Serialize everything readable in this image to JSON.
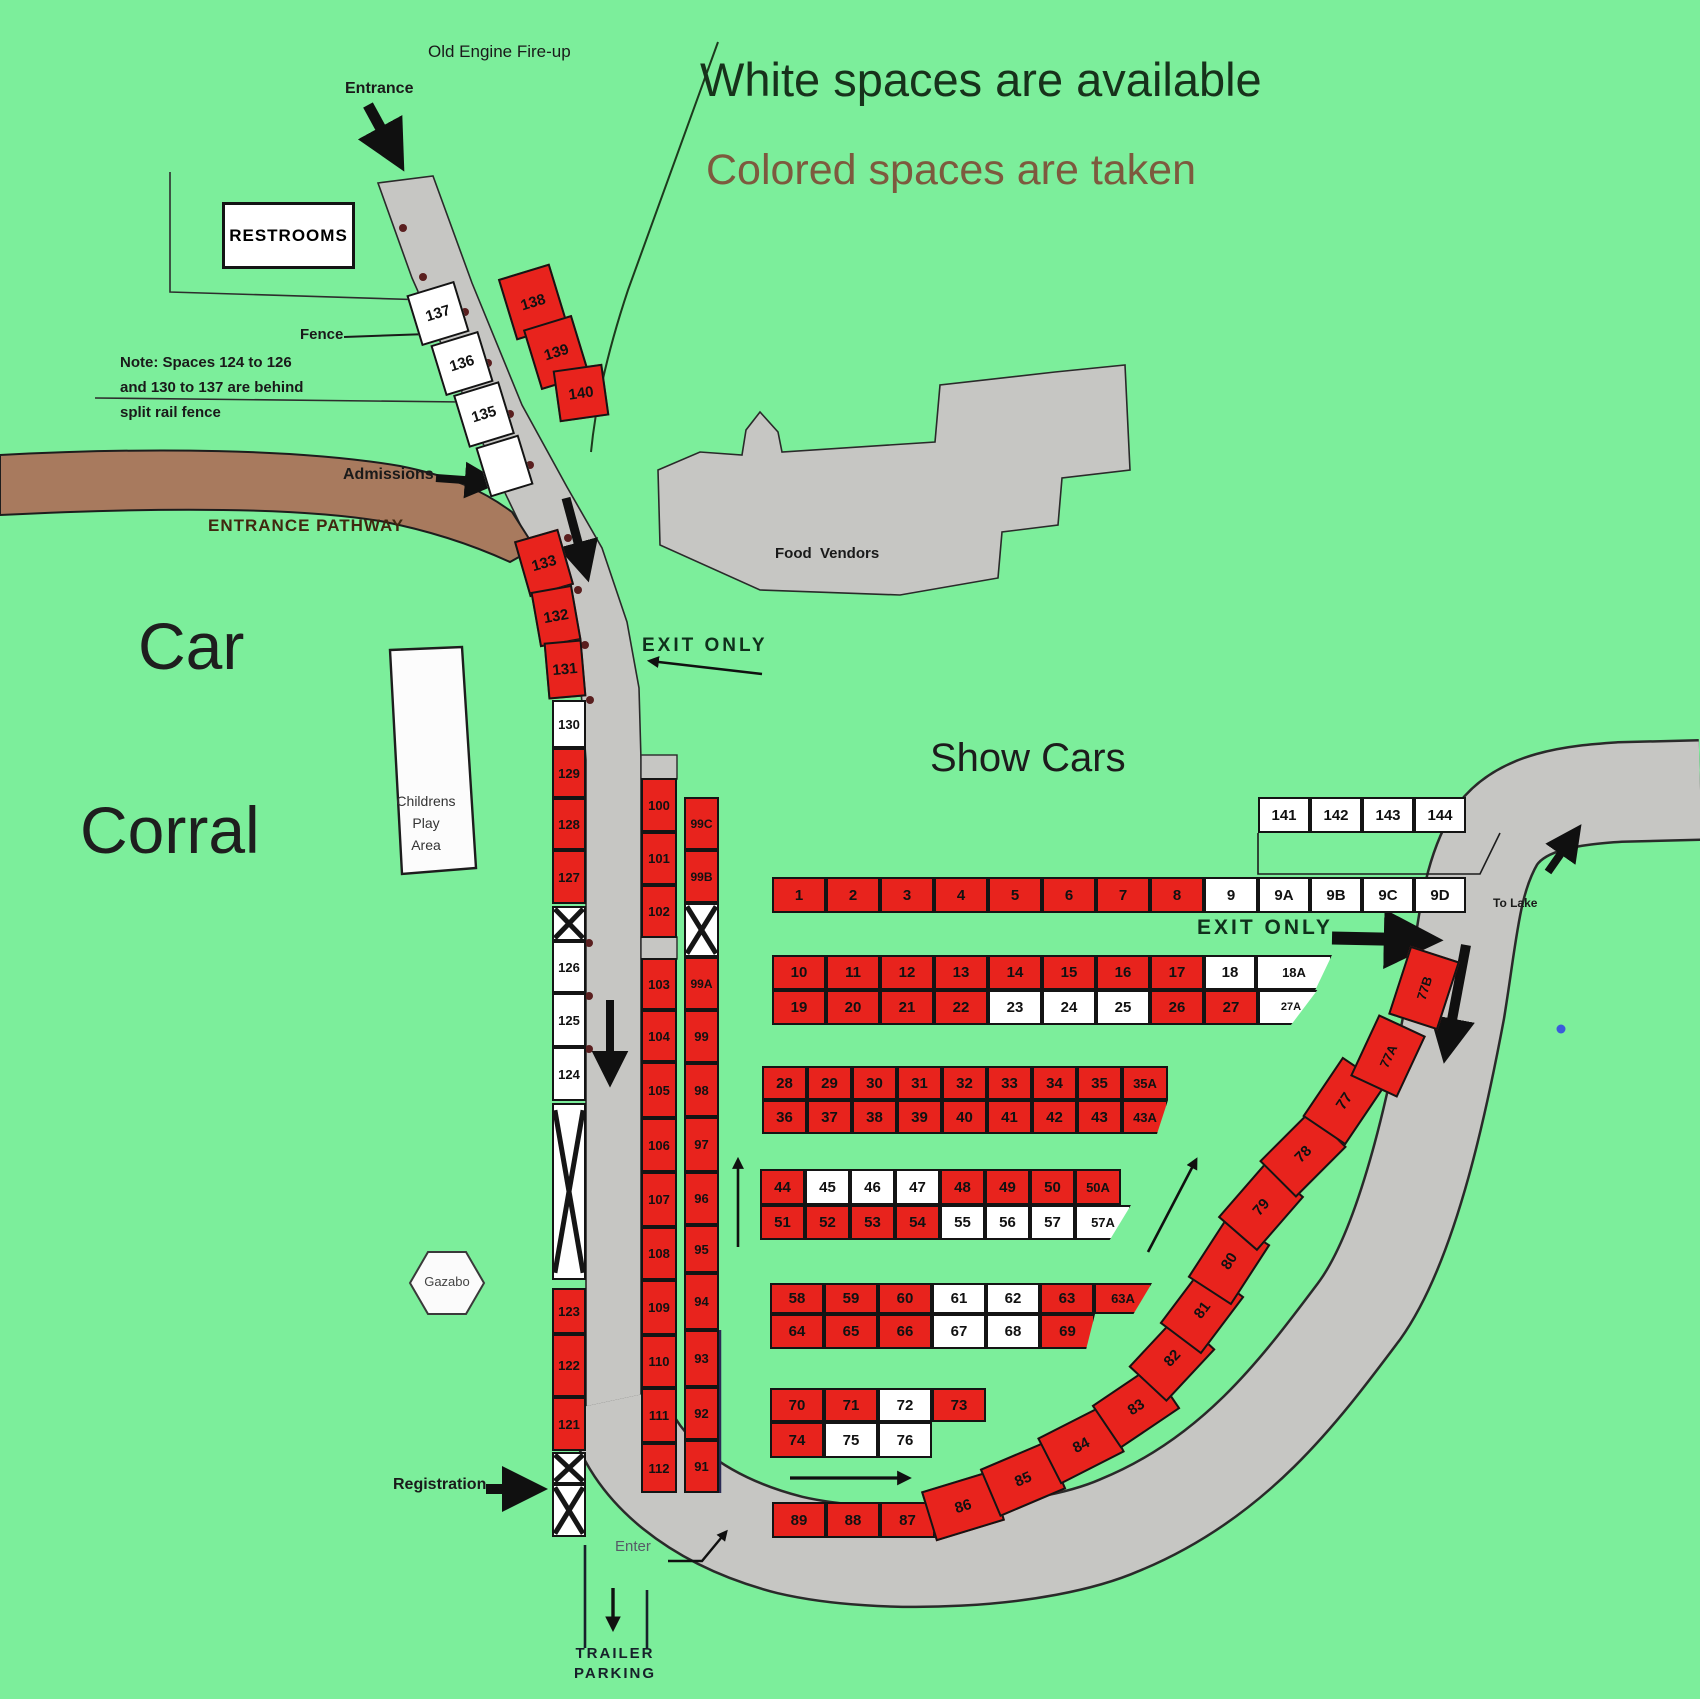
{
  "labels": {
    "old_engine": "Old Engine Fire-up",
    "entrance": "Entrance",
    "legend_available": "White spaces are available",
    "legend_taken": "Colored spaces are taken",
    "restrooms": "RESTROOMS",
    "fence": "Fence",
    "note_line1": "Note: Spaces 124 to 126",
    "note_line2": "and 130 to 137 are behind",
    "note_line3": "split rail fence",
    "admissions": "Admissions",
    "entrance_pathway": "ENTRANCE PATHWAY",
    "car": "Car",
    "corral": "Corral",
    "childrens_line1": "Childrens",
    "childrens_line2": "Play",
    "childrens_line3": "Area",
    "exit_only_left": "EXIT ONLY",
    "show_cars": "Show Cars",
    "food_vendors": "Food  Vendors",
    "exit_only_right": "EXIT ONLY",
    "to_lake": "To Lake",
    "gazabo": "Gazabo",
    "registration": "Registration",
    "enter": "Enter",
    "trailer_line1": "TRAILER",
    "trailer_line2": "PARKING"
  },
  "colors": {
    "bg": "#7cee9b",
    "taken": "#e8231d",
    "available": "#ffffff",
    "road": "#c6c6c3",
    "pathway": "#a87a5e",
    "legend_taken_text": "#7d5a3e"
  },
  "status_legend": {
    "white": "available",
    "colored": "taken"
  },
  "spaces": [
    {
      "id": "137",
      "x": 413,
      "y": 287,
      "w": 50,
      "h": 53,
      "r": -17,
      "st": "a"
    },
    {
      "id": "136",
      "x": 437,
      "y": 337,
      "w": 50,
      "h": 53,
      "r": -17,
      "st": "a"
    },
    {
      "id": "135",
      "x": 460,
      "y": 387,
      "w": 48,
      "h": 55,
      "r": -17,
      "st": "a"
    },
    {
      "id": "",
      "x": 482,
      "y": 440,
      "w": 45,
      "h": 52,
      "r": -17,
      "st": "a"
    },
    {
      "id": "138",
      "x": 506,
      "y": 270,
      "w": 54,
      "h": 64,
      "r": -17,
      "st": "t"
    },
    {
      "id": "139",
      "x": 531,
      "y": 321,
      "w": 51,
      "h": 63,
      "r": -17,
      "st": "t"
    },
    {
      "id": "140",
      "x": 556,
      "y": 367,
      "w": 50,
      "h": 52,
      "r": -8,
      "st": "t"
    },
    {
      "id": "133",
      "x": 521,
      "y": 534,
      "w": 46,
      "h": 58,
      "r": -16,
      "st": "t"
    },
    {
      "id": "132",
      "x": 535,
      "y": 588,
      "w": 42,
      "h": 56,
      "r": -10,
      "st": "t"
    },
    {
      "id": "131",
      "x": 546,
      "y": 641,
      "w": 38,
      "h": 57,
      "r": -5,
      "st": "t"
    },
    {
      "id": "130",
      "x": 552,
      "y": 700,
      "w": 34,
      "h": 48,
      "st": "a"
    },
    {
      "id": "129",
      "x": 552,
      "y": 748,
      "w": 34,
      "h": 50,
      "st": "t"
    },
    {
      "id": "128",
      "x": 552,
      "y": 798,
      "w": 34,
      "h": 52,
      "st": "t"
    },
    {
      "id": "127",
      "x": 552,
      "y": 850,
      "w": 34,
      "h": 54,
      "st": "t"
    },
    {
      "id": "",
      "x": 552,
      "y": 906,
      "w": 34,
      "h": 35,
      "st": "a",
      "xm": true
    },
    {
      "id": "126",
      "x": 552,
      "y": 941,
      "w": 34,
      "h": 52,
      "st": "a"
    },
    {
      "id": "125",
      "x": 552,
      "y": 993,
      "w": 34,
      "h": 54,
      "st": "a"
    },
    {
      "id": "124",
      "x": 552,
      "y": 1047,
      "w": 34,
      "h": 54,
      "st": "a"
    },
    {
      "id": "",
      "x": 552,
      "y": 1103,
      "w": 34,
      "h": 177,
      "st": "a",
      "xm": true
    },
    {
      "id": "123",
      "x": 552,
      "y": 1288,
      "w": 34,
      "h": 46,
      "st": "t"
    },
    {
      "id": "122",
      "x": 552,
      "y": 1334,
      "w": 34,
      "h": 63,
      "st": "t"
    },
    {
      "id": "121",
      "x": 552,
      "y": 1397,
      "w": 34,
      "h": 54,
      "st": "t"
    },
    {
      "id": "",
      "x": 552,
      "y": 1452,
      "w": 34,
      "h": 32,
      "st": "a",
      "xm": true
    },
    {
      "id": "",
      "x": 552,
      "y": 1484,
      "w": 34,
      "h": 53,
      "st": "a",
      "xm": true
    },
    {
      "id": "100",
      "x": 641,
      "y": 778,
      "w": 36,
      "h": 54,
      "st": "t"
    },
    {
      "id": "101",
      "x": 641,
      "y": 832,
      "w": 36,
      "h": 53,
      "st": "t"
    },
    {
      "id": "102",
      "x": 641,
      "y": 885,
      "w": 36,
      "h": 53,
      "st": "t"
    },
    {
      "id": "103",
      "x": 641,
      "y": 958,
      "w": 36,
      "h": 52,
      "st": "t"
    },
    {
      "id": "104",
      "x": 641,
      "y": 1010,
      "w": 36,
      "h": 52,
      "st": "t"
    },
    {
      "id": "105",
      "x": 641,
      "y": 1062,
      "w": 36,
      "h": 56,
      "st": "t"
    },
    {
      "id": "106",
      "x": 641,
      "y": 1118,
      "w": 36,
      "h": 54,
      "st": "t"
    },
    {
      "id": "107",
      "x": 641,
      "y": 1172,
      "w": 36,
      "h": 55,
      "st": "t"
    },
    {
      "id": "108",
      "x": 641,
      "y": 1227,
      "w": 36,
      "h": 53,
      "st": "t"
    },
    {
      "id": "109",
      "x": 641,
      "y": 1280,
      "w": 36,
      "h": 55,
      "st": "t"
    },
    {
      "id": "110",
      "x": 641,
      "y": 1335,
      "w": 36,
      "h": 53,
      "st": "t"
    },
    {
      "id": "111",
      "x": 641,
      "y": 1388,
      "w": 36,
      "h": 55,
      "st": "t"
    },
    {
      "id": "112",
      "x": 641,
      "y": 1443,
      "w": 36,
      "h": 50,
      "st": "t"
    },
    {
      "id": "99C",
      "x": 684,
      "y": 797,
      "w": 35,
      "h": 53,
      "st": "t",
      "fs": 12
    },
    {
      "id": "99B",
      "x": 684,
      "y": 850,
      "w": 35,
      "h": 53,
      "st": "t",
      "fs": 12
    },
    {
      "id": "",
      "x": 684,
      "y": 903,
      "w": 35,
      "h": 54,
      "st": "a",
      "xm": true
    },
    {
      "id": "99A",
      "x": 684,
      "y": 957,
      "w": 35,
      "h": 53,
      "st": "t",
      "fs": 12
    },
    {
      "id": "99",
      "x": 684,
      "y": 1010,
      "w": 35,
      "h": 53,
      "st": "t"
    },
    {
      "id": "98",
      "x": 684,
      "y": 1063,
      "w": 35,
      "h": 54,
      "st": "t"
    },
    {
      "id": "97",
      "x": 684,
      "y": 1117,
      "w": 35,
      "h": 55,
      "st": "t"
    },
    {
      "id": "96",
      "x": 684,
      "y": 1172,
      "w": 35,
      "h": 53,
      "st": "t"
    },
    {
      "id": "95",
      "x": 684,
      "y": 1225,
      "w": 35,
      "h": 48,
      "st": "t"
    },
    {
      "id": "94",
      "x": 684,
      "y": 1273,
      "w": 35,
      "h": 57,
      "st": "t"
    },
    {
      "id": "93",
      "x": 684,
      "y": 1330,
      "w": 35,
      "h": 57,
      "st": "t"
    },
    {
      "id": "92",
      "x": 684,
      "y": 1387,
      "w": 35,
      "h": 53,
      "st": "t"
    },
    {
      "id": "91",
      "x": 684,
      "y": 1440,
      "w": 35,
      "h": 53,
      "st": "t"
    },
    {
      "id": "141",
      "x": 1258,
      "y": 797,
      "w": 52,
      "h": 36,
      "st": "a"
    },
    {
      "id": "142",
      "x": 1310,
      "y": 797,
      "w": 52,
      "h": 36,
      "st": "a"
    },
    {
      "id": "143",
      "x": 1362,
      "y": 797,
      "w": 52,
      "h": 36,
      "st": "a"
    },
    {
      "id": "144",
      "x": 1414,
      "y": 797,
      "w": 52,
      "h": 36,
      "st": "a"
    },
    {
      "id": "1",
      "x": 772,
      "y": 877,
      "w": 54,
      "h": 36,
      "st": "t"
    },
    {
      "id": "2",
      "x": 826,
      "y": 877,
      "w": 54,
      "h": 36,
      "st": "t"
    },
    {
      "id": "3",
      "x": 880,
      "y": 877,
      "w": 54,
      "h": 36,
      "st": "t"
    },
    {
      "id": "4",
      "x": 934,
      "y": 877,
      "w": 54,
      "h": 36,
      "st": "t"
    },
    {
      "id": "5",
      "x": 988,
      "y": 877,
      "w": 54,
      "h": 36,
      "st": "t"
    },
    {
      "id": "6",
      "x": 1042,
      "y": 877,
      "w": 54,
      "h": 36,
      "st": "t"
    },
    {
      "id": "7",
      "x": 1096,
      "y": 877,
      "w": 54,
      "h": 36,
      "st": "t"
    },
    {
      "id": "8",
      "x": 1150,
      "y": 877,
      "w": 54,
      "h": 36,
      "st": "t"
    },
    {
      "id": "9",
      "x": 1204,
      "y": 877,
      "w": 54,
      "h": 36,
      "st": "a"
    },
    {
      "id": "9A",
      "x": 1258,
      "y": 877,
      "w": 52,
      "h": 36,
      "st": "a"
    },
    {
      "id": "9B",
      "x": 1310,
      "y": 877,
      "w": 52,
      "h": 36,
      "st": "a"
    },
    {
      "id": "9C",
      "x": 1362,
      "y": 877,
      "w": 52,
      "h": 36,
      "st": "a"
    },
    {
      "id": "9D",
      "x": 1414,
      "y": 877,
      "w": 52,
      "h": 36,
      "st": "a"
    },
    {
      "id": "10",
      "x": 772,
      "y": 955,
      "w": 54,
      "h": 35,
      "st": "t"
    },
    {
      "id": "11",
      "x": 826,
      "y": 955,
      "w": 54,
      "h": 35,
      "st": "t"
    },
    {
      "id": "12",
      "x": 880,
      "y": 955,
      "w": 54,
      "h": 35,
      "st": "t"
    },
    {
      "id": "13",
      "x": 934,
      "y": 955,
      "w": 54,
      "h": 35,
      "st": "t"
    },
    {
      "id": "14",
      "x": 988,
      "y": 955,
      "w": 54,
      "h": 35,
      "st": "t"
    },
    {
      "id": "15",
      "x": 1042,
      "y": 955,
      "w": 54,
      "h": 35,
      "st": "t"
    },
    {
      "id": "16",
      "x": 1096,
      "y": 955,
      "w": 54,
      "h": 35,
      "st": "t"
    },
    {
      "id": "17",
      "x": 1150,
      "y": 955,
      "w": 54,
      "h": 35,
      "st": "t"
    },
    {
      "id": "18",
      "x": 1204,
      "y": 955,
      "w": 52,
      "h": 35,
      "st": "a"
    },
    {
      "id": "18A",
      "x": 1256,
      "y": 955,
      "w": 76,
      "h": 35,
      "st": "a",
      "fs": 13,
      "clip": "c18A"
    },
    {
      "id": "19",
      "x": 772,
      "y": 990,
      "w": 54,
      "h": 35,
      "st": "t"
    },
    {
      "id": "20",
      "x": 826,
      "y": 990,
      "w": 54,
      "h": 35,
      "st": "t"
    },
    {
      "id": "21",
      "x": 880,
      "y": 990,
      "w": 54,
      "h": 35,
      "st": "t"
    },
    {
      "id": "22",
      "x": 934,
      "y": 990,
      "w": 54,
      "h": 35,
      "st": "t"
    },
    {
      "id": "23",
      "x": 988,
      "y": 990,
      "w": 54,
      "h": 35,
      "st": "a"
    },
    {
      "id": "24",
      "x": 1042,
      "y": 990,
      "w": 54,
      "h": 35,
      "st": "a"
    },
    {
      "id": "25",
      "x": 1096,
      "y": 990,
      "w": 54,
      "h": 35,
      "st": "a"
    },
    {
      "id": "26",
      "x": 1150,
      "y": 990,
      "w": 54,
      "h": 35,
      "st": "t"
    },
    {
      "id": "27",
      "x": 1204,
      "y": 990,
      "w": 54,
      "h": 35,
      "st": "t"
    },
    {
      "id": "27A",
      "x": 1258,
      "y": 990,
      "w": 66,
      "h": 35,
      "st": "a",
      "fs": 11,
      "clip": "c27A"
    },
    {
      "id": "28",
      "x": 762,
      "y": 1066,
      "w": 45,
      "h": 34,
      "st": "t"
    },
    {
      "id": "29",
      "x": 807,
      "y": 1066,
      "w": 45,
      "h": 34,
      "st": "t"
    },
    {
      "id": "30",
      "x": 852,
      "y": 1066,
      "w": 45,
      "h": 34,
      "st": "t"
    },
    {
      "id": "31",
      "x": 897,
      "y": 1066,
      "w": 45,
      "h": 34,
      "st": "t"
    },
    {
      "id": "32",
      "x": 942,
      "y": 1066,
      "w": 45,
      "h": 34,
      "st": "t"
    },
    {
      "id": "33",
      "x": 987,
      "y": 1066,
      "w": 45,
      "h": 34,
      "st": "t"
    },
    {
      "id": "34",
      "x": 1032,
      "y": 1066,
      "w": 45,
      "h": 34,
      "st": "t"
    },
    {
      "id": "35",
      "x": 1077,
      "y": 1066,
      "w": 45,
      "h": 34,
      "st": "t"
    },
    {
      "id": "35A",
      "x": 1122,
      "y": 1066,
      "w": 46,
      "h": 34,
      "st": "t",
      "fs": 13
    },
    {
      "id": "36",
      "x": 762,
      "y": 1100,
      "w": 45,
      "h": 34,
      "st": "t"
    },
    {
      "id": "37",
      "x": 807,
      "y": 1100,
      "w": 45,
      "h": 34,
      "st": "t"
    },
    {
      "id": "38",
      "x": 852,
      "y": 1100,
      "w": 45,
      "h": 34,
      "st": "t"
    },
    {
      "id": "39",
      "x": 897,
      "y": 1100,
      "w": 45,
      "h": 34,
      "st": "t"
    },
    {
      "id": "40",
      "x": 942,
      "y": 1100,
      "w": 45,
      "h": 34,
      "st": "t"
    },
    {
      "id": "41",
      "x": 987,
      "y": 1100,
      "w": 45,
      "h": 34,
      "st": "t"
    },
    {
      "id": "42",
      "x": 1032,
      "y": 1100,
      "w": 45,
      "h": 34,
      "st": "t"
    },
    {
      "id": "43",
      "x": 1077,
      "y": 1100,
      "w": 45,
      "h": 34,
      "st": "t"
    },
    {
      "id": "43A",
      "x": 1122,
      "y": 1100,
      "w": 46,
      "h": 34,
      "st": "t",
      "fs": 13,
      "clip": "c43A"
    },
    {
      "id": "44",
      "x": 760,
      "y": 1169,
      "w": 45,
      "h": 36,
      "st": "t"
    },
    {
      "id": "45",
      "x": 805,
      "y": 1169,
      "w": 45,
      "h": 36,
      "st": "a"
    },
    {
      "id": "46",
      "x": 850,
      "y": 1169,
      "w": 45,
      "h": 36,
      "st": "a"
    },
    {
      "id": "47",
      "x": 895,
      "y": 1169,
      "w": 45,
      "h": 36,
      "st": "a"
    },
    {
      "id": "48",
      "x": 940,
      "y": 1169,
      "w": 45,
      "h": 36,
      "st": "t"
    },
    {
      "id": "49",
      "x": 985,
      "y": 1169,
      "w": 45,
      "h": 36,
      "st": "t"
    },
    {
      "id": "50",
      "x": 1030,
      "y": 1169,
      "w": 45,
      "h": 36,
      "st": "t"
    },
    {
      "id": "50A",
      "x": 1075,
      "y": 1169,
      "w": 46,
      "h": 36,
      "st": "t",
      "fs": 13
    },
    {
      "id": "51",
      "x": 760,
      "y": 1205,
      "w": 45,
      "h": 35,
      "st": "t"
    },
    {
      "id": "52",
      "x": 805,
      "y": 1205,
      "w": 45,
      "h": 35,
      "st": "t"
    },
    {
      "id": "53",
      "x": 850,
      "y": 1205,
      "w": 45,
      "h": 35,
      "st": "t"
    },
    {
      "id": "54",
      "x": 895,
      "y": 1205,
      "w": 45,
      "h": 35,
      "st": "t"
    },
    {
      "id": "55",
      "x": 940,
      "y": 1205,
      "w": 45,
      "h": 35,
      "st": "a"
    },
    {
      "id": "56",
      "x": 985,
      "y": 1205,
      "w": 45,
      "h": 35,
      "st": "a"
    },
    {
      "id": "57",
      "x": 1030,
      "y": 1205,
      "w": 45,
      "h": 35,
      "st": "a"
    },
    {
      "id": "57A",
      "x": 1075,
      "y": 1205,
      "w": 56,
      "h": 35,
      "st": "a",
      "fs": 13,
      "clip": "c57A"
    },
    {
      "id": "58",
      "x": 770,
      "y": 1283,
      "w": 54,
      "h": 31,
      "st": "t"
    },
    {
      "id": "59",
      "x": 824,
      "y": 1283,
      "w": 54,
      "h": 31,
      "st": "t"
    },
    {
      "id": "60",
      "x": 878,
      "y": 1283,
      "w": 54,
      "h": 31,
      "st": "t"
    },
    {
      "id": "61",
      "x": 932,
      "y": 1283,
      "w": 54,
      "h": 31,
      "st": "a"
    },
    {
      "id": "62",
      "x": 986,
      "y": 1283,
      "w": 54,
      "h": 31,
      "st": "a"
    },
    {
      "id": "63",
      "x": 1040,
      "y": 1283,
      "w": 54,
      "h": 31,
      "st": "t"
    },
    {
      "id": "63A",
      "x": 1094,
      "y": 1283,
      "w": 58,
      "h": 31,
      "st": "t",
      "fs": 13,
      "clip": "c63A"
    },
    {
      "id": "64",
      "x": 770,
      "y": 1314,
      "w": 54,
      "h": 35,
      "st": "t"
    },
    {
      "id": "65",
      "x": 824,
      "y": 1314,
      "w": 54,
      "h": 35,
      "st": "t"
    },
    {
      "id": "66",
      "x": 878,
      "y": 1314,
      "w": 54,
      "h": 35,
      "st": "t"
    },
    {
      "id": "67",
      "x": 932,
      "y": 1314,
      "w": 54,
      "h": 35,
      "st": "a"
    },
    {
      "id": "68",
      "x": 986,
      "y": 1314,
      "w": 54,
      "h": 35,
      "st": "a"
    },
    {
      "id": "69",
      "x": 1040,
      "y": 1314,
      "w": 55,
      "h": 35,
      "st": "t",
      "clip": "c69"
    },
    {
      "id": "70",
      "x": 770,
      "y": 1388,
      "w": 54,
      "h": 34,
      "st": "t"
    },
    {
      "id": "71",
      "x": 824,
      "y": 1388,
      "w": 54,
      "h": 34,
      "st": "t"
    },
    {
      "id": "72",
      "x": 878,
      "y": 1388,
      "w": 54,
      "h": 34,
      "st": "a"
    },
    {
      "id": "73",
      "x": 932,
      "y": 1388,
      "w": 54,
      "h": 34,
      "st": "t"
    },
    {
      "id": "74",
      "x": 770,
      "y": 1422,
      "w": 54,
      "h": 36,
      "st": "t"
    },
    {
      "id": "75",
      "x": 824,
      "y": 1422,
      "w": 54,
      "h": 36,
      "st": "a"
    },
    {
      "id": "76",
      "x": 878,
      "y": 1422,
      "w": 54,
      "h": 36,
      "st": "a"
    },
    {
      "id": "89",
      "x": 772,
      "y": 1502,
      "w": 54,
      "h": 36,
      "st": "t"
    },
    {
      "id": "88",
      "x": 826,
      "y": 1502,
      "w": 54,
      "h": 36,
      "st": "t"
    },
    {
      "id": "87",
      "x": 880,
      "y": 1502,
      "w": 55,
      "h": 36,
      "st": "t"
    },
    {
      "id": "86",
      "x": 927,
      "y": 1480,
      "w": 72,
      "h": 52,
      "r": -17,
      "st": "t"
    },
    {
      "id": "85",
      "x": 987,
      "y": 1453,
      "w": 72,
      "h": 52,
      "r": -23,
      "st": "t"
    },
    {
      "id": "84",
      "x": 1045,
      "y": 1419,
      "w": 72,
      "h": 52,
      "r": -27,
      "st": "t"
    },
    {
      "id": "83",
      "x": 1100,
      "y": 1381,
      "w": 72,
      "h": 52,
      "r": -34,
      "st": "t"
    },
    {
      "id": "82",
      "x": 1136,
      "y": 1332,
      "w": 72,
      "h": 52,
      "r": -47,
      "st": "t"
    },
    {
      "id": "81",
      "x": 1166,
      "y": 1284,
      "w": 72,
      "h": 52,
      "r": -53,
      "st": "t"
    },
    {
      "id": "80",
      "x": 1193,
      "y": 1235,
      "w": 72,
      "h": 52,
      "r": -57,
      "st": "t"
    },
    {
      "id": "79",
      "x": 1225,
      "y": 1181,
      "w": 72,
      "h": 52,
      "r": -49,
      "st": "t"
    },
    {
      "id": "78",
      "x": 1267,
      "y": 1128,
      "w": 72,
      "h": 52,
      "r": -45,
      "st": "t"
    },
    {
      "id": "77",
      "x": 1308,
      "y": 1075,
      "w": 72,
      "h": 52,
      "r": -56,
      "st": "t"
    },
    {
      "id": "77A",
      "x": 1354,
      "y": 1030,
      "w": 68,
      "h": 52,
      "r": -65,
      "st": "t",
      "fs": 13
    },
    {
      "id": "77B",
      "x": 1388,
      "y": 962,
      "w": 72,
      "h": 52,
      "r": -72,
      "st": "t",
      "fs": 13
    }
  ]
}
